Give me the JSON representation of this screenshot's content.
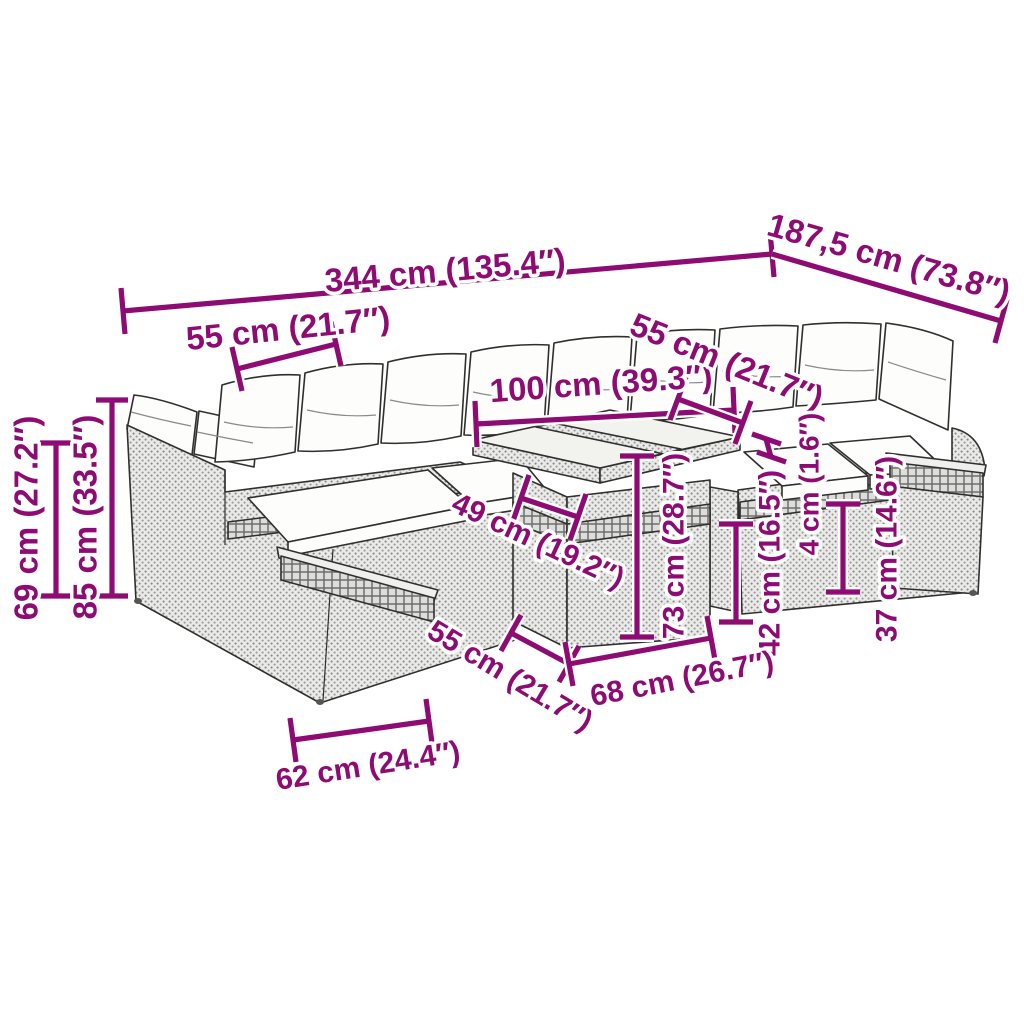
{
  "page": {
    "background": "#ffffff",
    "accent_color": "#8D0B73",
    "line_color": "#2f2f2d"
  },
  "diagram": {
    "subject": "rattan garden sofa set with glass-top table, dimension drawing",
    "dimensions": {
      "total_width": "344 cm (135.4″)",
      "total_depth": "187,5 cm (73.8″)",
      "left_section_width": "55 cm (21.7″)",
      "table_top_width": "100 cm (39.3″)",
      "right_section_width": "55 cm (21.7″)",
      "left_back_height": "69 cm (27.2″)",
      "total_height": "85 cm (33.5″)",
      "table_top_depth": "49 cm (19.2″)",
      "table_height": "73 cm (28.7″)",
      "seat_height": "42 cm (16.5″)",
      "armrest_gap": "4 cm (1.6″)",
      "base_height": "37 cm (14.6″)",
      "table_base_depth": "55 cm (21.7″)",
      "table_base_width": "68 cm (26.7″)",
      "seat_depth": "62 cm (24.4″)"
    }
  }
}
